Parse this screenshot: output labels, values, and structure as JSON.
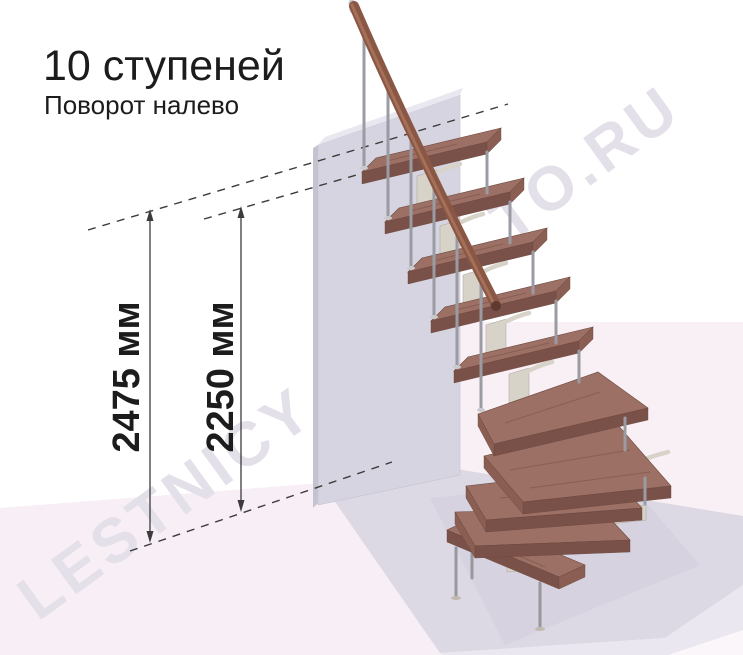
{
  "header": {
    "title": "10 ступеней",
    "subtitle": "Поворот налево"
  },
  "dimensions": {
    "overall": {
      "label": "2475 мм",
      "value": 2475,
      "unit": "мм"
    },
    "to_top_step": {
      "label": "2250 мм",
      "value": 2250,
      "unit": "мм"
    }
  },
  "watermark": {
    "left_fragment": "LESTNICY",
    "right_fragment": "TO.RU"
  },
  "colors": {
    "text": "#1c1c1c",
    "annotation": "#3c3c3c",
    "watermark": "#e3e0e9",
    "wood_top": "#9d7065",
    "wood_front": "#7a5148",
    "wood_end": "#8a5e53",
    "wood_edge": "#6b463d",
    "rail": "#8a5744",
    "rail_hi": "#a5705a",
    "rail_end": "#5f3a2f",
    "metal_light": "#d8d3c9",
    "metal_mid": "#c0bab0",
    "metal_dark": "#a9a298",
    "baluster": "#9b9ca3",
    "baluster_light": "#c9cace",
    "leg": "#97989e",
    "wall_front": "#d6d4e0",
    "wall_top": "#e9e7ef",
    "wall_edge": "#c6c3d1",
    "floor_pink": "#f8eef5",
    "floor_platform": "#dcd8e4",
    "platform_front": "#eae7f0",
    "bg_right_pink": "#f8f0f5",
    "shadow": "#cfcbd9"
  }
}
